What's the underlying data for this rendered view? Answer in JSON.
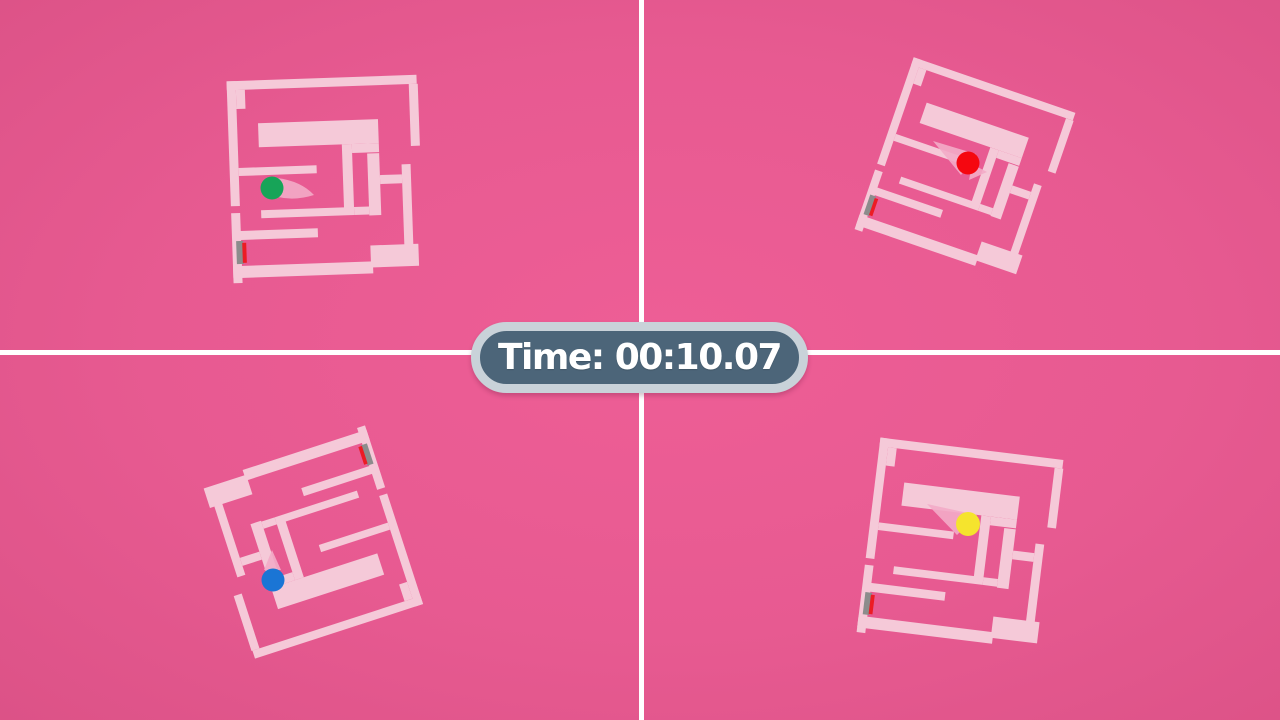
{
  "hud": {
    "timer_label": "Time: 00:10.07",
    "badge_fill": "#4c6579",
    "badge_ring": "#c9d2d9",
    "badge_text_color": "#ffffff"
  },
  "colors": {
    "background": "#e75a91",
    "wall": "#f5c9d8",
    "trail": "#f3abc8",
    "divider": "#ffffff",
    "goal_gray": "#8c8c8c",
    "goal_red": "#ec1c24"
  },
  "dividers": {
    "vertical_x": 639,
    "horizontal_y": 350,
    "thickness": 5
  },
  "maze": {
    "width": 194,
    "height": 206,
    "walls": [
      [
        2,
        2,
        190,
        9
      ],
      [
        184,
        11,
        9,
        62
      ],
      [
        2,
        2,
        9,
        125
      ],
      [
        11,
        11,
        9,
        19
      ],
      [
        11,
        89,
        78,
        8
      ],
      [
        32,
        45,
        120,
        24
      ],
      [
        115,
        69,
        10,
        66
      ],
      [
        32,
        132,
        93,
        8
      ],
      [
        125,
        69,
        27,
        9
      ],
      [
        140,
        79,
        12,
        62
      ],
      [
        125,
        132,
        15,
        8
      ],
      [
        174,
        91,
        9,
        93
      ],
      [
        152,
        101,
        22,
        9
      ],
      [
        4,
        152,
        84,
        9
      ],
      [
        2,
        134,
        9,
        70
      ],
      [
        2,
        187,
        140,
        12
      ],
      [
        140,
        171,
        48,
        22
      ]
    ],
    "goal_gray_rect": [
      6,
      162,
      7,
      23
    ],
    "goal_red_rect": [
      12,
      164,
      4,
      20
    ]
  },
  "quadrants": [
    {
      "id": "top-left",
      "player": "green",
      "ball_color": "#17a458",
      "center": [
        325,
        179
      ],
      "rotation": -2,
      "scale": 1.0,
      "ball": {
        "x": 272,
        "y": 188,
        "r": 11.5
      },
      "trails": [
        "M277,178 Q301,181 314,195 Q295,201 278,197 Z"
      ]
    },
    {
      "id": "top-right",
      "player": "red",
      "ball_color": "#f50710",
      "center": [
        965,
        171
      ],
      "rotation": 19,
      "scale": 0.9,
      "ball": {
        "x": 968,
        "y": 163,
        "r": 11.5
      },
      "trails": [
        "M933,141 L976,154 L961,175 Z",
        "M972,164 L987,172 L969,180 Z"
      ]
    },
    {
      "id": "bottom-left",
      "player": "blue",
      "ball_color": "#1a75d5",
      "center": [
        310,
        542
      ],
      "rotation": 162,
      "scale": 0.93,
      "ball": {
        "x": 273,
        "y": 580,
        "r": 11.5
      },
      "trails": [
        "M272,550 L281,570 L264,570 Z"
      ]
    },
    {
      "id": "bottom-right",
      "player": "yellow",
      "ball_color": "#f5e42d",
      "center": [
        960,
        546
      ],
      "rotation": 7,
      "scale": 0.97,
      "ball": {
        "x": 968,
        "y": 524,
        "r": 12
      },
      "trails": [
        "M927,504 L977,515 L957,535 Z"
      ]
    }
  ]
}
